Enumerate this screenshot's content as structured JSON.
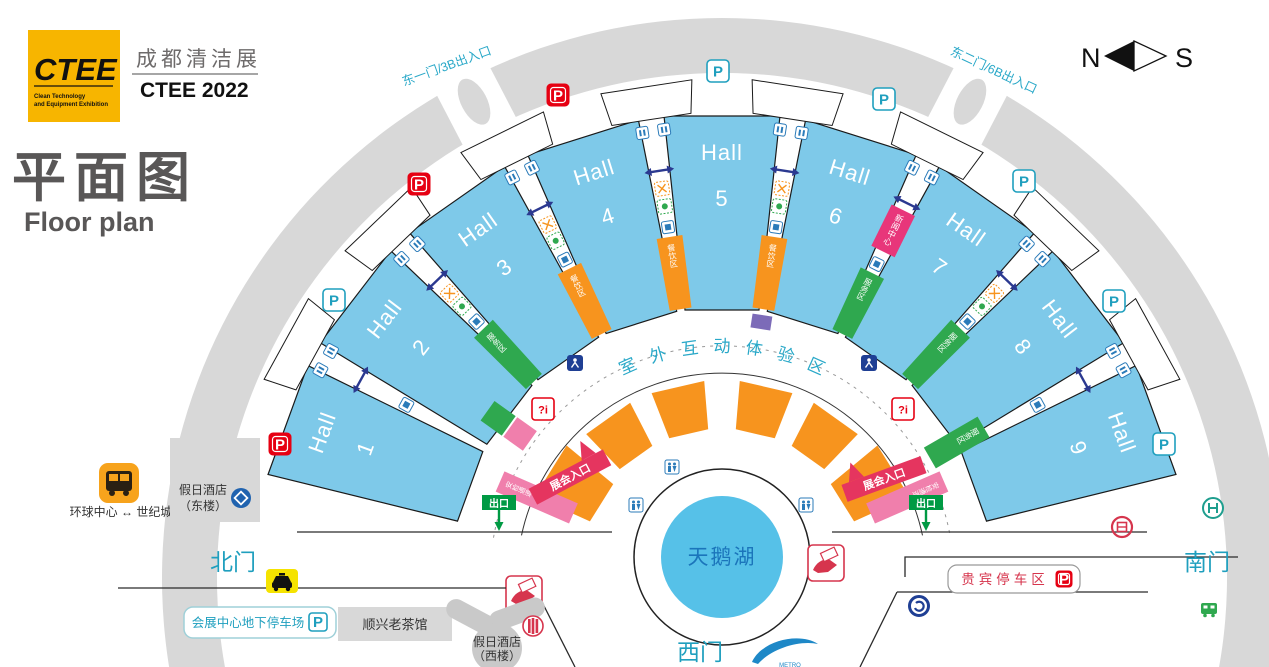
{
  "logo": {
    "acronym": "CTEE",
    "tagline1": "Clean Technology",
    "tagline2": "and Equipment Exhibition",
    "event_cn": "成都清洁展",
    "event_en": "CTEE 2022"
  },
  "title": {
    "cn": "平面图",
    "en": "Floor plan"
  },
  "compass": {
    "n": "N",
    "s": "S"
  },
  "gates": {
    "north": "北门",
    "south": "南门",
    "west": "西门",
    "east1": "东一门/3B出入口",
    "east2": "东二门/6B出入口"
  },
  "halls": [
    {
      "label": "Hall",
      "num": "1"
    },
    {
      "label": "Hall",
      "num": "2"
    },
    {
      "label": "Hall",
      "num": "3"
    },
    {
      "label": "Hall",
      "num": "4"
    },
    {
      "label": "Hall",
      "num": "5"
    },
    {
      "label": "Hall",
      "num": "6"
    },
    {
      "label": "Hall",
      "num": "7"
    },
    {
      "label": "Hall",
      "num": "8"
    },
    {
      "label": "Hall",
      "num": "9"
    }
  ],
  "lake": "天鹅湖",
  "plaza_chars": [
    "室",
    "外",
    "互",
    "动",
    "体",
    "验",
    "区"
  ],
  "signs": {
    "expo_entrance": "展会入口",
    "exit": "出口",
    "security": "安检通道",
    "news_center": "新闻中心",
    "dining": "餐饮区",
    "service": "服务区",
    "info": "?i",
    "parking": "P"
  },
  "places": {
    "underground_parking": "会展中心地下停车场",
    "vip_parking": "贵宾停车区",
    "teahouse": "顺兴老茶馆",
    "hotel_east_l1": "假日酒店",
    "hotel_east_l2": "（东楼）",
    "hotel_west_l1": "假日酒店",
    "hotel_west_l2": "（西楼）",
    "shuttle": "环球中心 ↔ 世纪城",
    "metro": "METRO"
  },
  "colors": {
    "hall_blue": "#7EC9E9",
    "lake_blue": "#56C1E8",
    "road_gray": "#D8D8D8",
    "teal": "#1F9FBE",
    "orange": "#F7941E",
    "green": "#2FA84F",
    "pink": "#E8367A",
    "red": "#E60012",
    "navy": "#2B3990",
    "logo_yellow": "#F7B500",
    "title_gray": "#595757"
  }
}
